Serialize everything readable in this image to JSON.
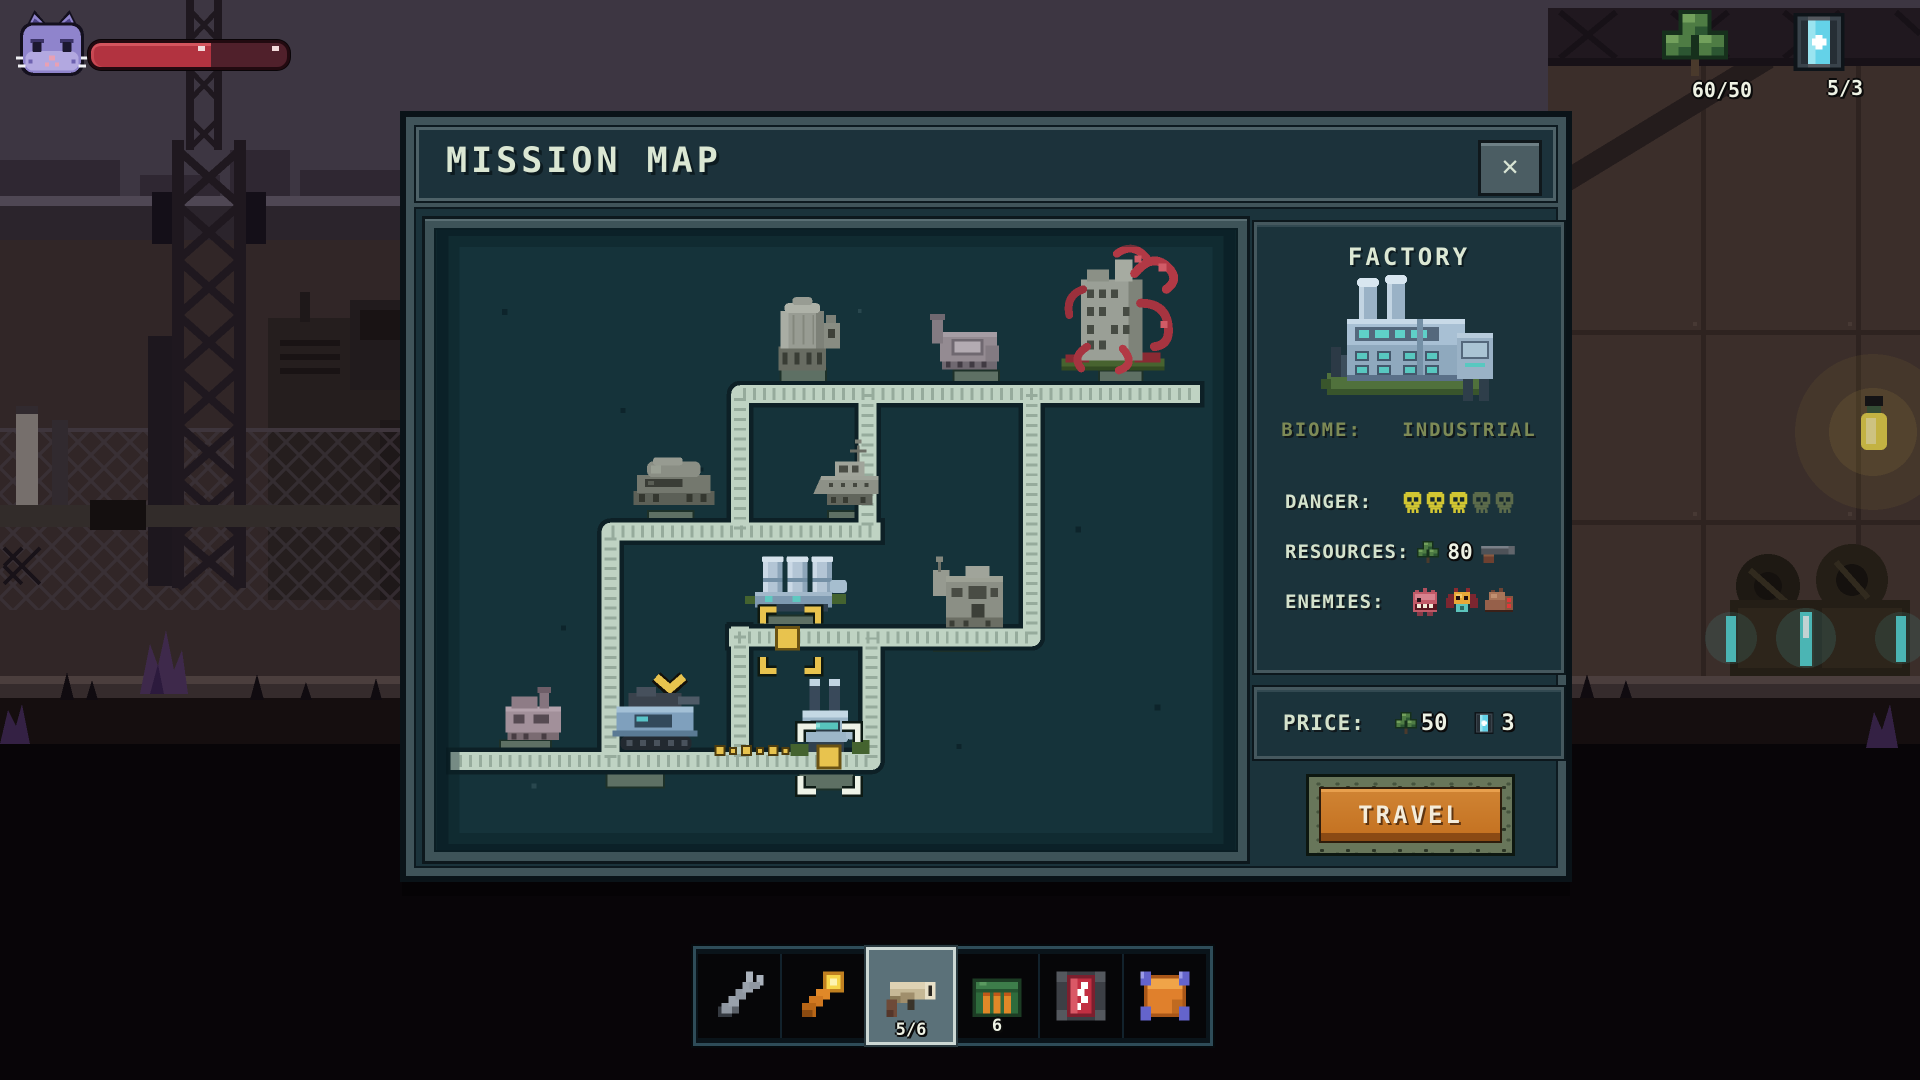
{
  "hud": {
    "avatar": "cat",
    "health_pct": 61,
    "resources": [
      {
        "name": "scrap",
        "value": "60/50"
      },
      {
        "name": "portal-charge",
        "value": "5/3"
      }
    ]
  },
  "dialog": {
    "title": "MISSION MAP",
    "close_glyph": "✕"
  },
  "map_nodes": [
    "silo",
    "plant",
    "infested-ruin",
    "bunker-dome",
    "gunship-dock",
    "power-plant",
    "warehouse",
    "outpost",
    "player-tank",
    "factory"
  ],
  "info_panel": {
    "title": "FACTORY",
    "biome_label": "BIOME:",
    "biome_value": "INDUSTRIAL",
    "danger_label": "DANGER:",
    "danger_filled": 3,
    "danger_total": 5,
    "resources_label": "RESOURCES:",
    "resources_value": "80",
    "enemies_label": "ENEMIES:"
  },
  "price_panel": {
    "label": "PRICE:",
    "scrap_cost": "50",
    "portal_cost": "3"
  },
  "travel_button": "TRAVEL",
  "hotbar": [
    {
      "item": "wrench",
      "count": "",
      "selected": false
    },
    {
      "item": "flashlight",
      "count": "",
      "selected": false
    },
    {
      "item": "revolver",
      "count": "5/6",
      "selected": true
    },
    {
      "item": "ammo-box",
      "count": "6",
      "selected": false
    },
    {
      "item": "battery",
      "count": "",
      "selected": false
    },
    {
      "item": "wire-spool",
      "count": "",
      "selected": false
    }
  ]
}
